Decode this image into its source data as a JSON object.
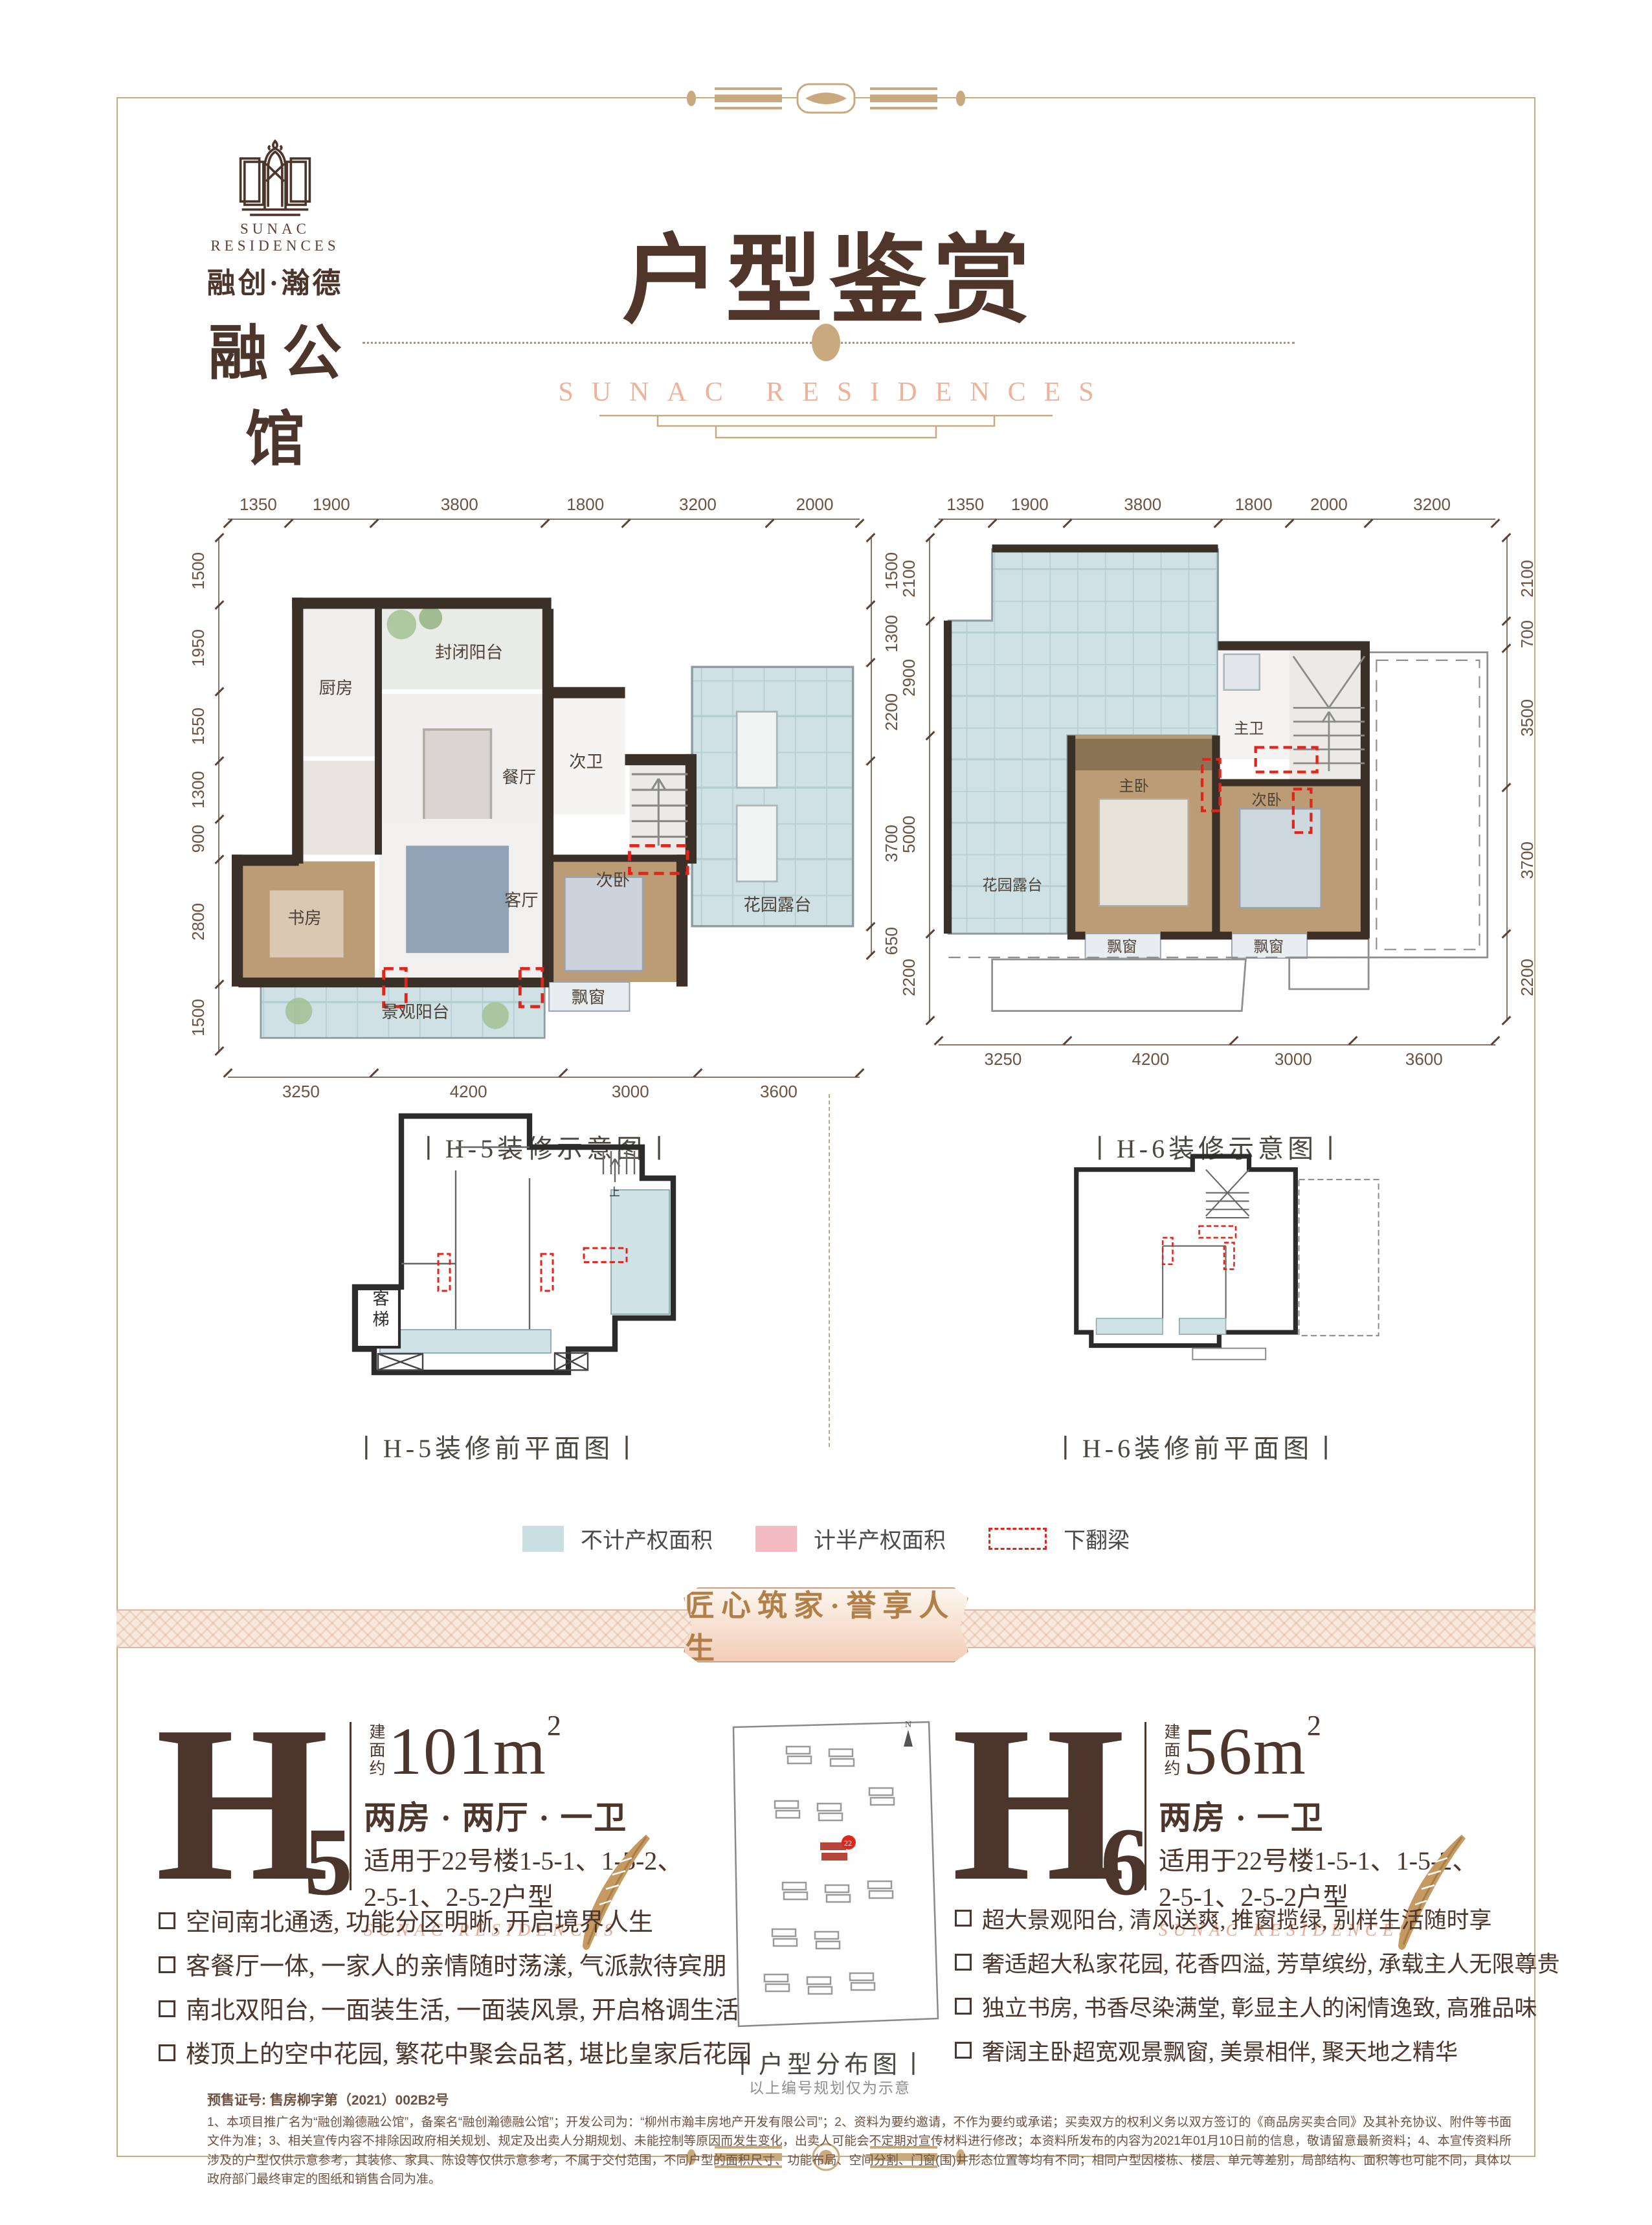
{
  "page": {
    "title": "户型鉴赏",
    "subtitle": "SUNAC RESIDENCES",
    "banner": "匠心筑家·誉享人生"
  },
  "logo": {
    "name_en": "SUNAC RESIDENCES",
    "brand": "融创·瀚德",
    "name_cn": "融公馆"
  },
  "plans": {
    "h5": {
      "caption": "丨H-5装修示意图丨",
      "dims_top": [
        1350,
        1900,
        3800,
        1800,
        3200,
        2000
      ],
      "dims_left": [
        1500,
        1950,
        1550,
        1300,
        900,
        2800,
        1500
      ],
      "dims_right": [
        1500,
        1300,
        2200,
        3700,
        650
      ],
      "dims_bottom": [
        3250,
        4200,
        3000,
        3600
      ],
      "rooms": {
        "balcony_closed": "封闭阳台",
        "kitchen": "厨房",
        "dining": "餐厅",
        "bath2": "次卫",
        "terrace": "花园露台",
        "study": "书房",
        "living": "客厅",
        "bed2": "次卧",
        "bay": "飘窗",
        "balcony_view": "景观阳台"
      }
    },
    "h6": {
      "caption": "丨H-6装修示意图丨",
      "dims_top": [
        1350,
        1900,
        3800,
        1800,
        2000,
        3200
      ],
      "dims_left": [
        2100,
        2900,
        5000,
        2200
      ],
      "dims_right": [
        2100,
        700,
        3500,
        3700,
        2200
      ],
      "dims_bottom": [
        3250,
        4200,
        3000,
        3600
      ],
      "rooms": {
        "terrace": "花园露台",
        "bath_m": "主卫",
        "bed_m": "主卧",
        "bed2": "次卧",
        "bay1": "飘窗",
        "bay2": "飘窗"
      }
    },
    "h5_pre": {
      "caption": "丨H-5装修前平面图丨",
      "elevator": "客梯",
      "up": "上"
    },
    "h6_pre": {
      "caption": "丨H-6装修前平面图丨"
    }
  },
  "legend": {
    "no_property": "不计产权面积",
    "half_property": "计半产权面积",
    "beam": "下翻梁",
    "colors": {
      "no_property": "#c9dfe2",
      "half_property": "#f4bcc2",
      "beam": "#e1251b"
    }
  },
  "units": {
    "h5": {
      "letter": "H",
      "num": "-5",
      "area_prefix": "建面约",
      "area": "101m",
      "area_sup": "2",
      "layout": "两房 · 两厅 · 一卫",
      "applicable1": "适用于22号楼1-5-1、1-5-2、",
      "applicable2": "2-5-1、2-5-2户型",
      "residences": "SUNAC RESIDENCES",
      "features": [
        "空间南北通透, 功能分区明晰, 开启境界人生",
        "客餐厅一体, 一家人的亲情随时荡漾, 气派款待宾朋",
        "南北双阳台, 一面装生活, 一面装风景, 开启格调生活",
        "楼顶上的空中花园, 繁花中聚会品茗, 堪比皇家后花园"
      ]
    },
    "h6": {
      "letter": "H",
      "num": "-6",
      "area_prefix": "建面约",
      "area": "56m",
      "area_sup": "2",
      "layout": "两房 · 一卫",
      "applicable1": "适用于22号楼1-5-1、1-5-2、",
      "applicable2": "2-5-1、2-5-2户型",
      "residences": "SUNAC RESIDENCES",
      "features": [
        "超大景观阳台, 清风送爽, 推窗揽绿, 别样生活随时享",
        "奢适超大私家花园, 花香四溢, 芳草缤纷, 承载主人无限尊贵",
        "独立书房, 书香尽染满堂, 彰显主人的闲情逸致, 高雅品味",
        "奢阔主卧超宽观景飘窗, 美景相伴, 聚天地之精华"
      ]
    }
  },
  "siteplan": {
    "caption": "丨户型分布图丨",
    "note": "以上编号规划仅为示意",
    "building_label": "22",
    "compass": "N"
  },
  "disclaimer": {
    "permit": "预售证号: 售房柳字第（2021）002B2号",
    "body": "1、本项目推广名为“融创瀚德融公馆”，备案名“融创瀚德融公馆”；开发公司为：“柳州市瀚丰房地产开发有限公司”；2、资料为要约邀请，不作为要约或承诺；买卖双方的权利义务以双方签订的《商品房买卖合同》及其补充协议、附件等书面文件为准；3、相关宣传内容不排除因政府相关规划、规定及出卖人分期规划、未能控制等原因而发生变化，出卖人可能会不定期对宣传材料进行修改；本资料所发布的内容为2021年01月10日前的信息，敬请留意最新资料；4、本宣传资料所涉及的户型仅供示意参考，其装修、家具、陈设等仅供示意参考，不属于交付范围，不同户型的面积尺寸、功能布局、空间分割、门窗(围)井形态位置等均有不同；相同户型因楼栋、楼层、单元等差别，局部结构、面积等也可能不同，具体以政府部门最终审定的图纸和销售合同为准。"
  }
}
